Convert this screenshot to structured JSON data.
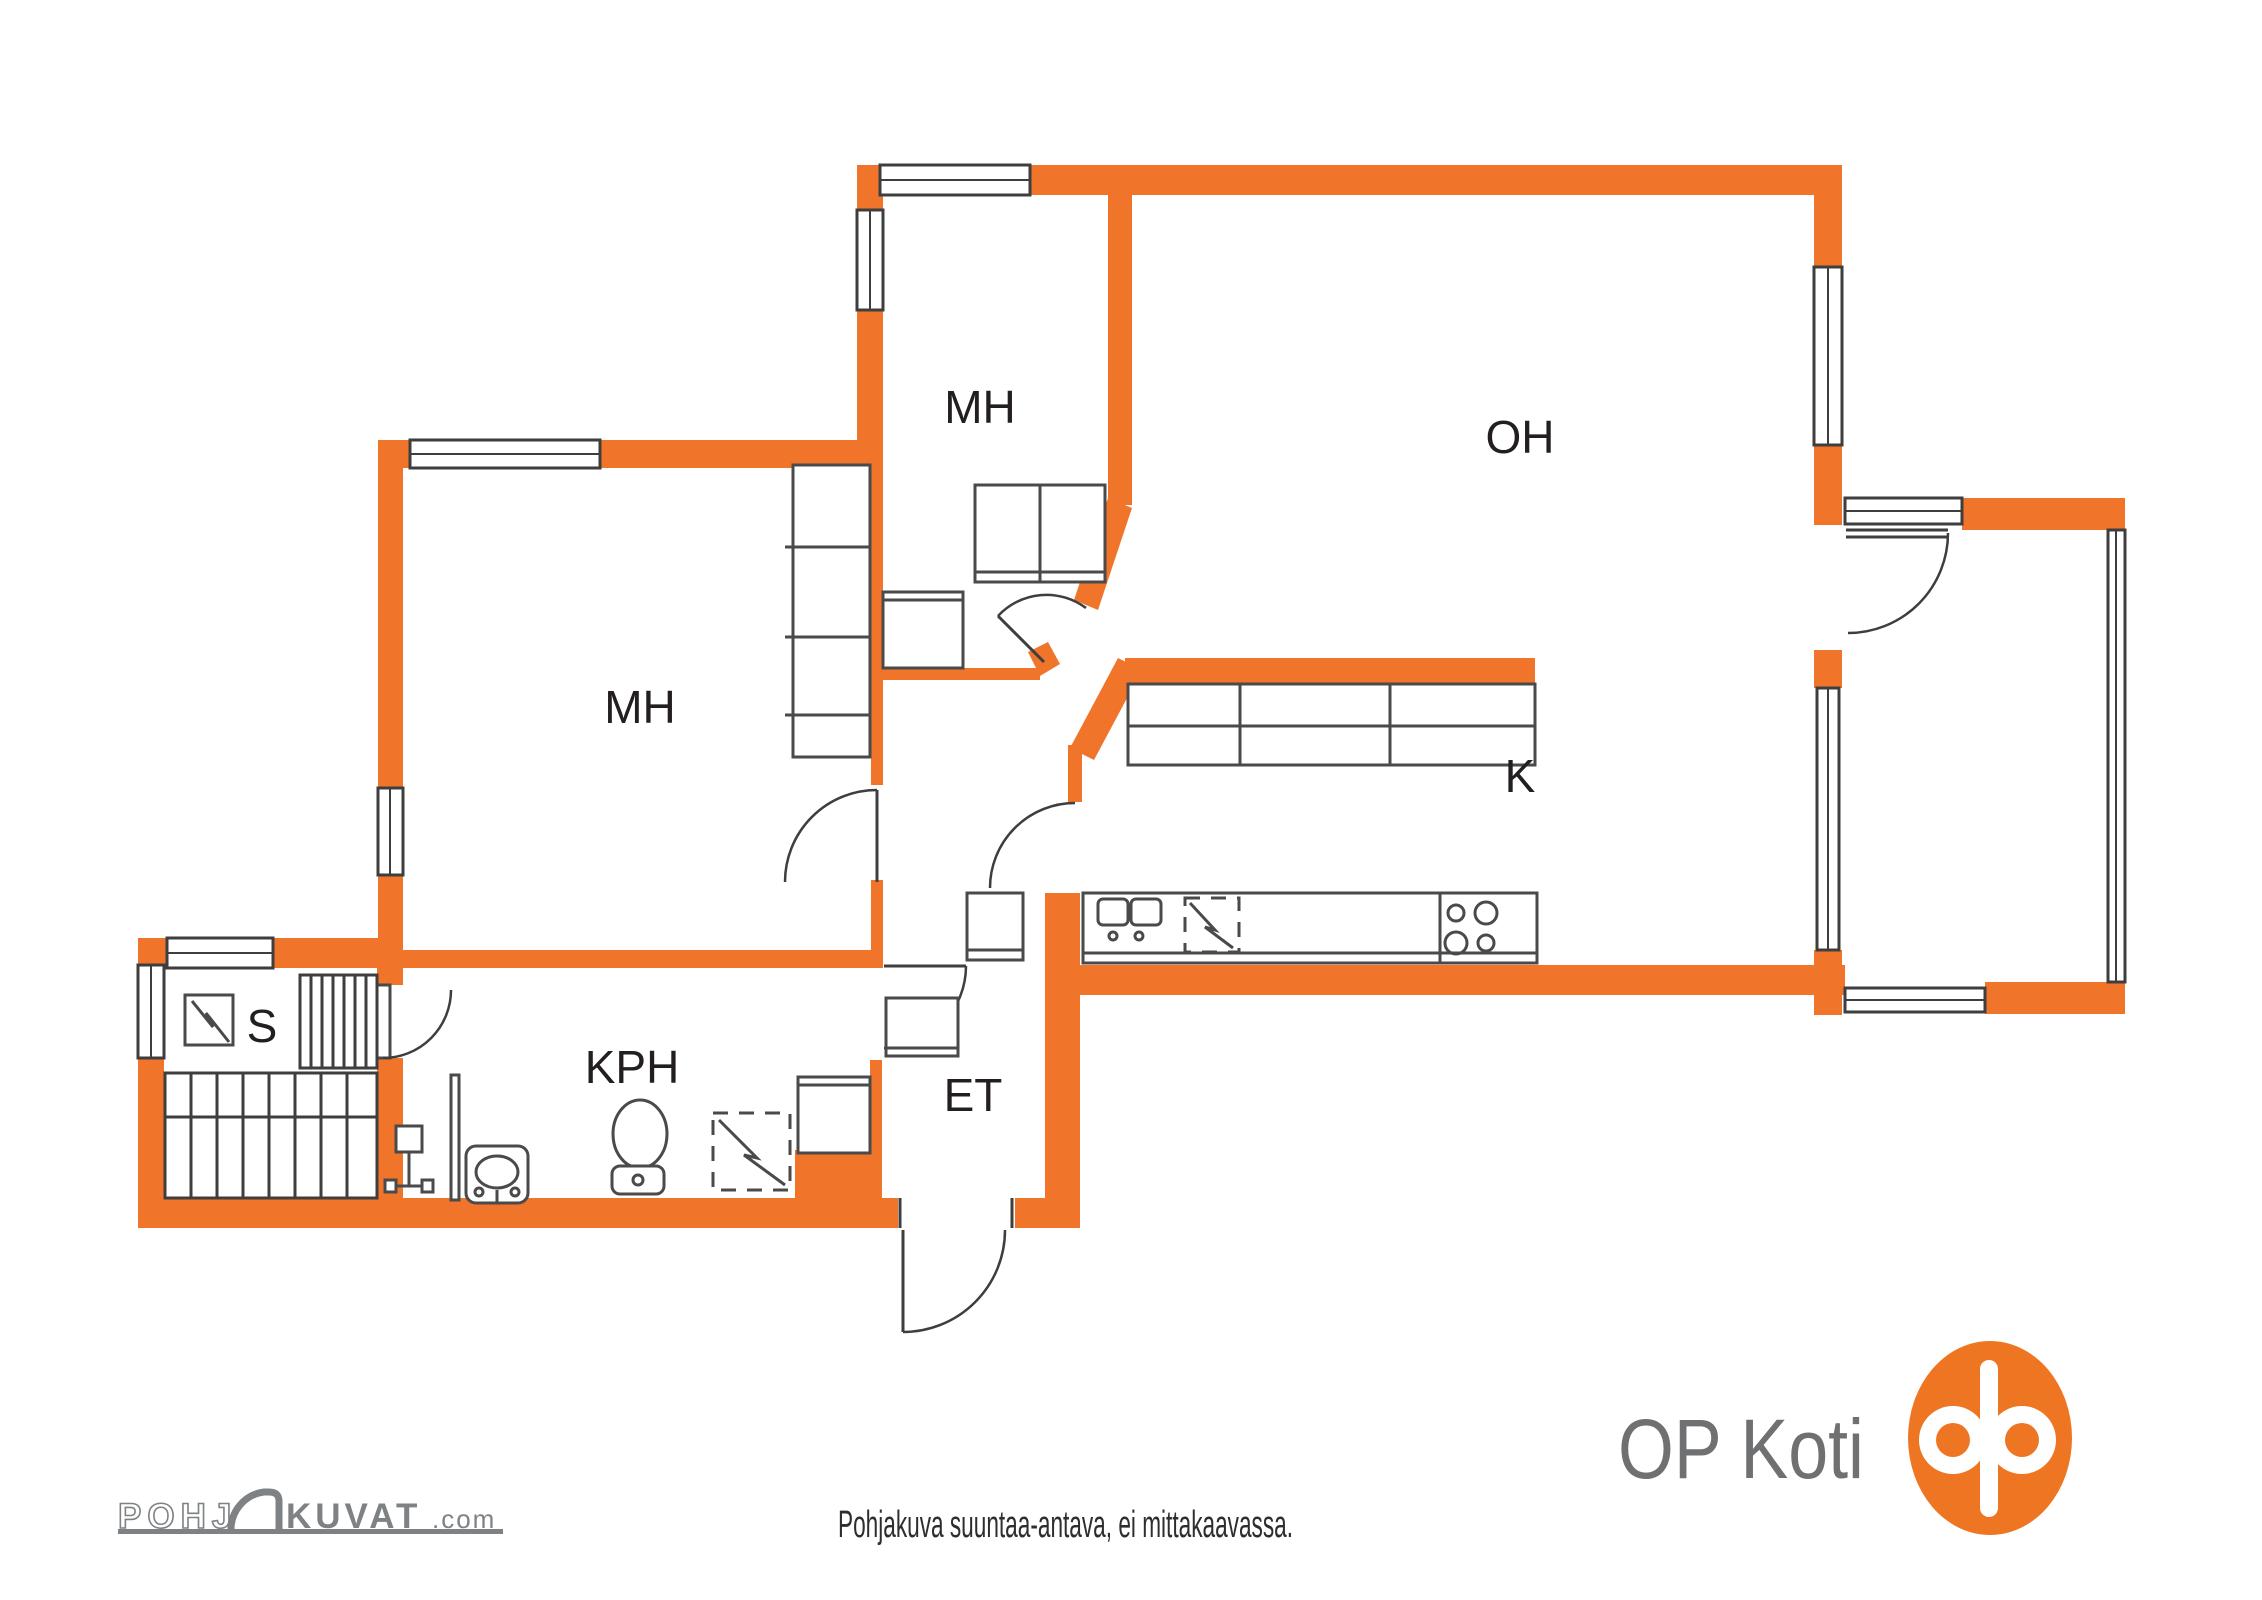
{
  "colors": {
    "wall": "#F0752B",
    "logo_orange": "#EE7623",
    "line": "#3E3E3E",
    "fixline": "#4A4A4A",
    "label": "#231F20",
    "caption": "#2E2E2E",
    "logo_gray": "#6F7072",
    "pk_gray": "#7F8284"
  },
  "plan": {
    "rooms": [
      {
        "id": "mh_top",
        "label": "MH"
      },
      {
        "id": "mh_left",
        "label": "MH"
      },
      {
        "id": "oh",
        "label": "OH"
      },
      {
        "id": "k",
        "label": "K"
      },
      {
        "id": "kph",
        "label": "KPH"
      },
      {
        "id": "et",
        "label": "ET"
      },
      {
        "id": "s",
        "label": "S"
      }
    ]
  },
  "footer": {
    "disclaimer": "Pohjakuva suuntaa-antava, ei mittakaavassa."
  },
  "branding": {
    "pohjakuvat": {
      "prefix": "POHJ",
      "main": "KUVAT",
      "tld": ".com"
    },
    "op_koti": {
      "wordmark": "OP Koti"
    }
  }
}
